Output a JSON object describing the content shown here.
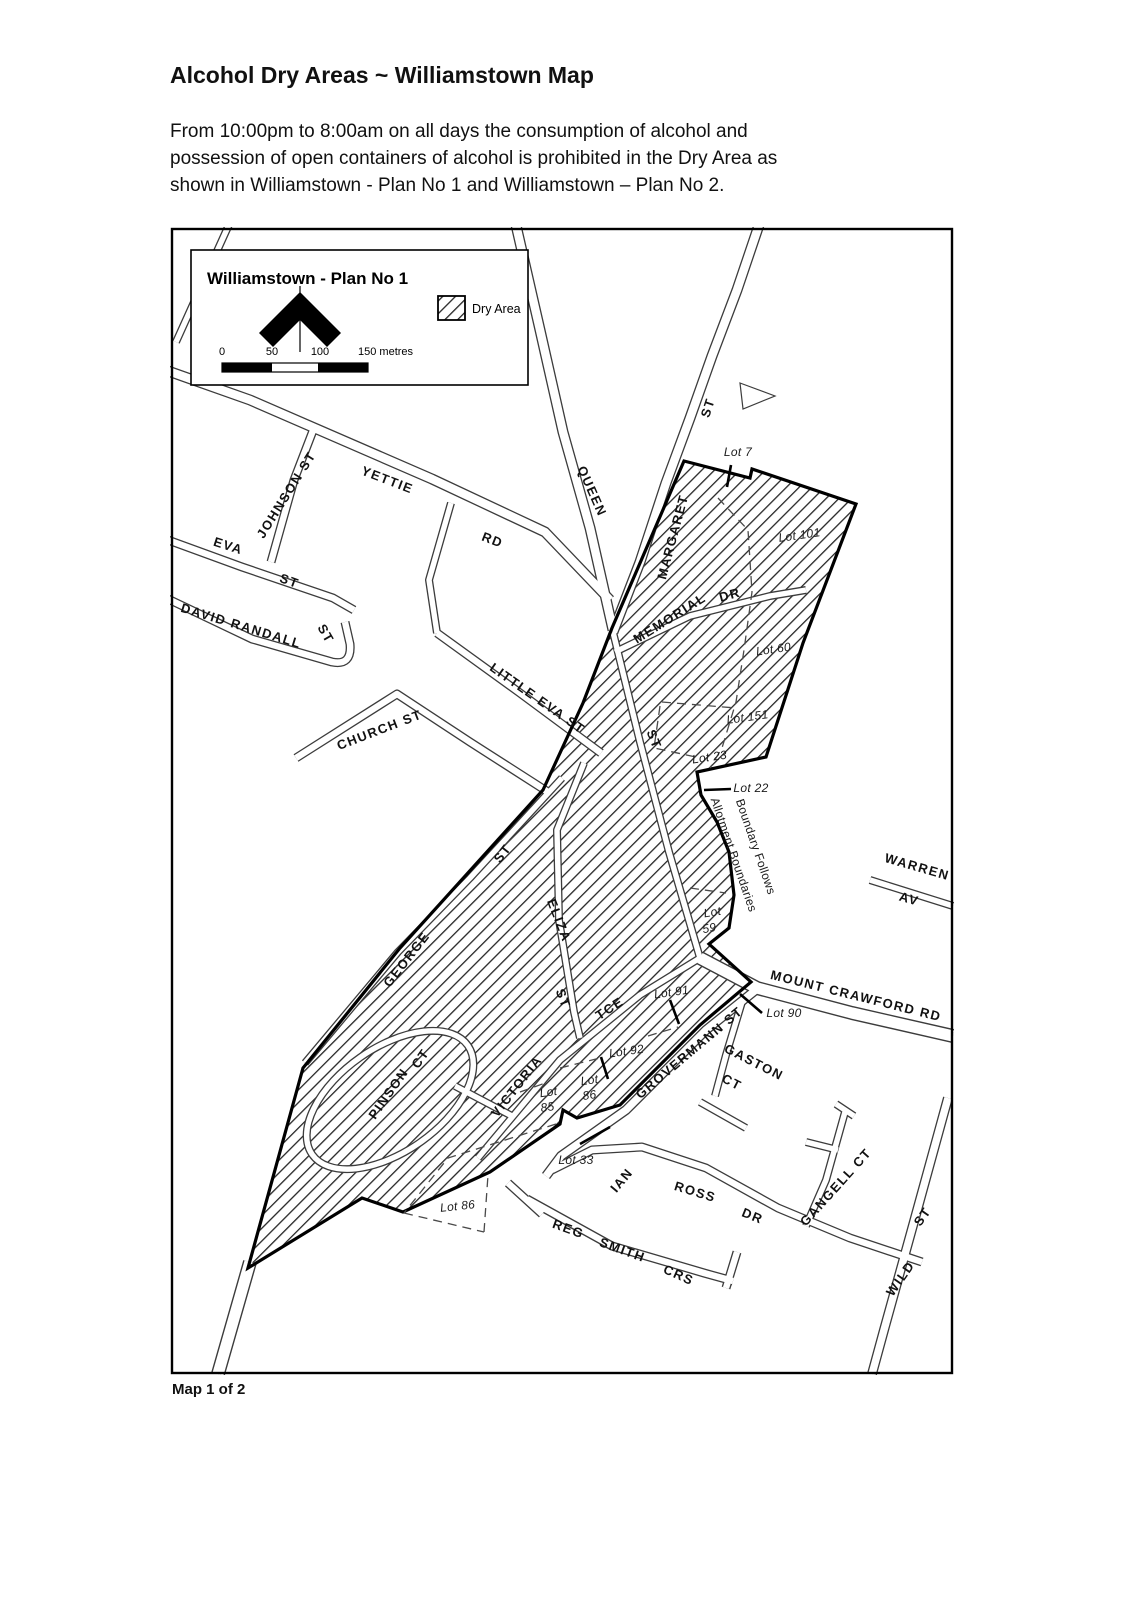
{
  "page": {
    "title": "Alcohol Dry Areas ~ Williamstown Map",
    "intro_lines": [
      "From 10:00pm to 8:00am on all days the consumption of alcohol and",
      "possession of open containers of alcohol is prohibited in the Dry Area as",
      "shown in Williamstown - Plan No 1 and Williamstown – Plan No 2."
    ],
    "caption": "Map 1 of 2"
  },
  "map": {
    "plan_title": "Williamstown - Plan No 1",
    "legend_label": "Dry Area",
    "scale_labels": [
      "0",
      "50",
      "100",
      "150 metres"
    ],
    "streets": [
      {
        "text": "JOHNSON ST"
      },
      {
        "text": "YETTIE"
      },
      {
        "text": "RD"
      },
      {
        "text": "EVA"
      },
      {
        "text": "ST"
      },
      {
        "text": "DAVID RANDALL"
      },
      {
        "text": "ST"
      },
      {
        "text": "LITTLE EVA ST"
      },
      {
        "text": "CHURCH ST"
      },
      {
        "text": "QUEEN"
      },
      {
        "text": "MARGARET"
      },
      {
        "text": "ST"
      },
      {
        "text": "MEMORIAL"
      },
      {
        "text": "DR"
      },
      {
        "text": "ST"
      },
      {
        "text": "GEORGE"
      },
      {
        "text": "ST"
      },
      {
        "text": "ELIZA"
      },
      {
        "text": "ST"
      },
      {
        "text": "VICTORIA"
      },
      {
        "text": "TCE"
      },
      {
        "text": "PINSON"
      },
      {
        "text": "CT"
      },
      {
        "text": "GROVERMANN ST"
      },
      {
        "text": "GASTON"
      },
      {
        "text": "CT"
      },
      {
        "text": "MOUNT CRAWFORD RD"
      },
      {
        "text": "WARREN"
      },
      {
        "text": "AV"
      },
      {
        "text": "IAN"
      },
      {
        "text": "ROSS"
      },
      {
        "text": "DR"
      },
      {
        "text": "REG"
      },
      {
        "text": "SMITH"
      },
      {
        "text": "CRS"
      },
      {
        "text": "GANGELL CT"
      },
      {
        "text": "WILD"
      },
      {
        "text": "ST"
      }
    ],
    "lots": [
      {
        "text": "Lot 7"
      },
      {
        "text": "Lot 101"
      },
      {
        "text": "Lot 60"
      },
      {
        "text": "Lot 151"
      },
      {
        "text": "Lot 23"
      },
      {
        "text": "Lot 22"
      },
      {
        "line1": "Lot",
        "line2": "59"
      },
      {
        "text": "Lot 91"
      },
      {
        "text": "Lot 90"
      },
      {
        "text": "Lot 92"
      },
      {
        "line1": "Lot",
        "line2": "86"
      },
      {
        "line1": "Lot",
        "line2": "85"
      },
      {
        "text": "Lot 33"
      },
      {
        "text": "Lot 86"
      }
    ],
    "boundary_note": {
      "line1": "Boundary Follows",
      "line2": "Allotment Boundaries"
    }
  },
  "colors": {
    "paper": "#ffffff",
    "boundary_line": "#000000",
    "road_casing": "#3c3c3c",
    "hatch_line": "#262626",
    "text": "#111111"
  }
}
